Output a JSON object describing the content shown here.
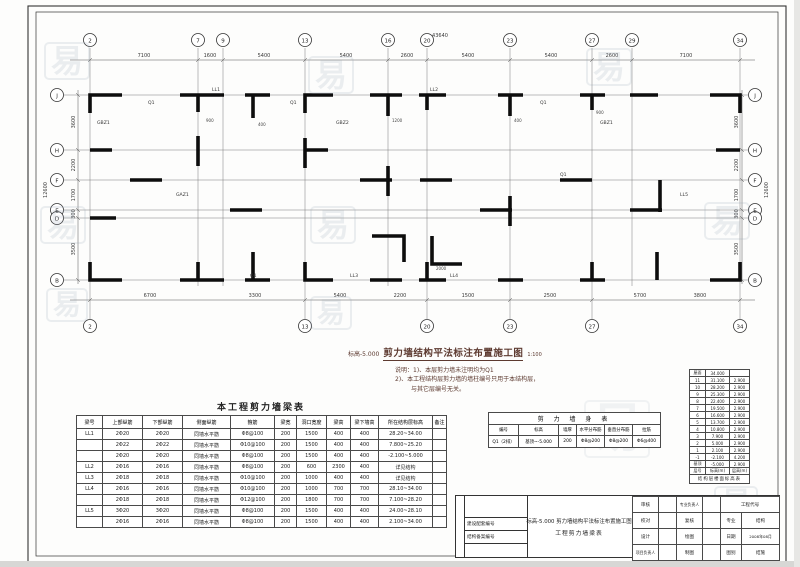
{
  "watermark": "易",
  "plan": {
    "elev_label": "标高-5.000",
    "title": "剪力墙结构平法标注布置施工图",
    "scale": "1:100",
    "notes": [
      "说明：1)、本层剪力墙未注明均为Q1",
      "2)、本工程结构层剪力墙的墙柱编号只用于本结构层，",
      "与其它层编号无关。"
    ],
    "grid_cols": [
      "2",
      "7",
      "9",
      "13",
      "16",
      "20",
      "23",
      "27",
      "29",
      "34"
    ],
    "grid_rows": [
      "J",
      "H",
      "F",
      "E",
      "D",
      "B"
    ],
    "col_dims": [
      "7100",
      "1600",
      "5400",
      "5400",
      "2600",
      "5400",
      "5400",
      "2600",
      "7100"
    ],
    "row_dims": [
      "3600",
      "2200",
      "1700",
      "300",
      "3500"
    ],
    "bottom_dims": [
      "6700",
      "3300",
      "5400",
      "2200",
      "1500",
      "2500",
      "5700",
      "3800"
    ],
    "total_width": "43640",
    "total_height": "12600",
    "wall_labels": [
      "Q1",
      "GBZ1",
      "LL1",
      "Q1",
      "GBZ2",
      "LL2",
      "Q1",
      "GBZ1",
      "LL3",
      "LL4",
      "GAZ1",
      "Q1",
      "LL5",
      "Q1"
    ],
    "small_dims": [
      "900",
      "400",
      "1200",
      "400",
      "900",
      "2000"
    ]
  },
  "beam_table": {
    "title": "本工程剪力墙梁表",
    "headers": [
      "梁号",
      "上部纵筋",
      "下部纵筋",
      "侧面纵筋",
      "箍筋",
      "梁宽",
      "洞口宽度",
      "梁高",
      "梁下墙高",
      "所在结构层标高",
      "备注"
    ],
    "rows": [
      [
        "LL1",
        "2Φ20",
        "2Φ20",
        "同墙水平筋",
        "Φ8@100",
        "200",
        "1500",
        "400",
        "400",
        "28.20~34.00",
        ""
      ],
      [
        "",
        "2Φ22",
        "2Φ22",
        "同墙水平筋",
        "Φ10@100",
        "200",
        "1500",
        "400",
        "400",
        "7.800~25.20",
        ""
      ],
      [
        "",
        "2Φ20",
        "2Φ20",
        "同墙水平筋",
        "Φ8@100",
        "200",
        "1500",
        "400",
        "400",
        "-2.100~5.000",
        ""
      ],
      [
        "LL2",
        "2Φ16",
        "2Φ16",
        "同墙水平筋",
        "Φ8@100",
        "200",
        "600",
        "2300",
        "400",
        "详见结构",
        ""
      ],
      [
        "LL3",
        "2Φ18",
        "2Φ18",
        "同墙水平筋",
        "Φ10@100",
        "200",
        "1000",
        "400",
        "400",
        "详见结构",
        ""
      ],
      [
        "LL4",
        "2Φ16",
        "2Φ16",
        "同墙水平筋",
        "Φ10@100",
        "200",
        "1000",
        "700",
        "700",
        "28.10~34.00",
        ""
      ],
      [
        "",
        "2Φ18",
        "2Φ18",
        "同墙水平筋",
        "Φ12@100",
        "200",
        "1800",
        "700",
        "700",
        "7.100~28.20",
        ""
      ],
      [
        "LL5",
        "3Φ20",
        "3Φ20",
        "同墙水平筋",
        "Φ8@100",
        "200",
        "1500",
        "400",
        "400",
        "24.00~28.10",
        ""
      ],
      [
        "",
        "2Φ16",
        "2Φ16",
        "同墙水平筋",
        "Φ8@100",
        "200",
        "1500",
        "400",
        "400",
        "2.100~34.00",
        ""
      ]
    ]
  },
  "wall_table": {
    "title": "剪 力 墙 身 表",
    "headers": [
      "编号",
      "标高",
      "墙厚",
      "水平分布筋",
      "垂直分布筋",
      "拉筋"
    ],
    "rows": [
      [
        "Q1（2排）",
        "基顶~-5.000",
        "200",
        "Φ8@200",
        "Φ8@200",
        "Φ6@400"
      ]
    ]
  },
  "floor_table": {
    "title": "结构层楼面标高表",
    "footer": [
      "层号",
      "标高(m)",
      "层高(m)"
    ],
    "rows": [
      [
        "屋面",
        "34.000",
        ""
      ],
      [
        "11",
        "31.100",
        "2.900"
      ],
      [
        "10",
        "28.200",
        "2.900"
      ],
      [
        "9",
        "25.300",
        "2.900"
      ],
      [
        "8",
        "22.400",
        "2.900"
      ],
      [
        "7",
        "19.500",
        "2.900"
      ],
      [
        "6",
        "16.600",
        "2.900"
      ],
      [
        "5",
        "13.700",
        "2.900"
      ],
      [
        "4",
        "10.800",
        "2.900"
      ],
      [
        "3",
        "7.900",
        "2.900"
      ],
      [
        "2",
        "5.000",
        "2.900"
      ],
      [
        "1",
        "2.100",
        "2.900"
      ],
      [
        "-1",
        "-2.100",
        "4.200"
      ],
      [
        "基顶",
        "-5.000",
        "2.900"
      ]
    ]
  },
  "titleblock": {
    "code_labels": [
      "建设配套编号",
      "结构备案编号"
    ],
    "title_line1": "标高-5.000 剪力墙结构平法标注布置施工图",
    "title_line2": "工程剪力墙梁表",
    "cells": {
      "r1l1": "审核",
      "r1v1": "",
      "r1l2": "专业负责人",
      "r1v2": "",
      "r1l3": "工程代号",
      "r2l1": "校对",
      "r2v1": "",
      "r2l2": "复核",
      "r2v2": "",
      "r2l3": "专业",
      "r2v3": "结构",
      "r3l1": "设计",
      "r3v1": "",
      "r3l2": "绘图",
      "r3v2": "",
      "r3l3": "日期",
      "r3v3": "2008年08月",
      "r4l1": "项目负责人",
      "r4v1": "",
      "r4l2": "制图",
      "r4v2": "",
      "r4l3": "图别",
      "r4v3": "结施"
    }
  }
}
